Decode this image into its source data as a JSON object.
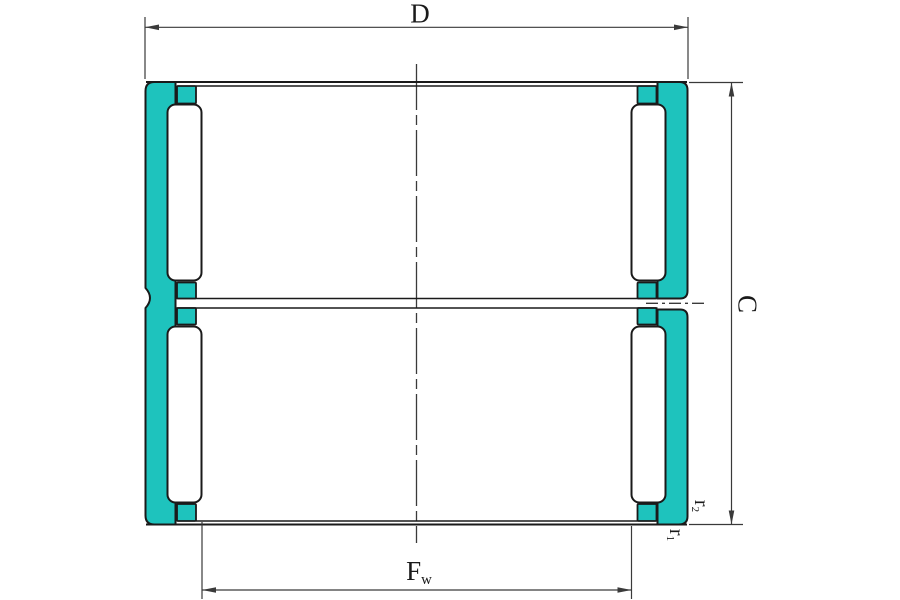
{
  "figure": {
    "labels": {
      "outer_diameter": "D",
      "width": "C",
      "raceway_main": "F",
      "raceway_sub": "w",
      "r1_main": "r",
      "r1_sub": "1",
      "r2_main": "r",
      "r2_sub": "2"
    },
    "colors": {
      "shell": "#1ec3bd",
      "roller": "#ffffff",
      "outline": "#1a1a1a",
      "dimension_line": "#3a3a3a",
      "text": "#1a1a1a",
      "background": "#ffffff"
    }
  }
}
